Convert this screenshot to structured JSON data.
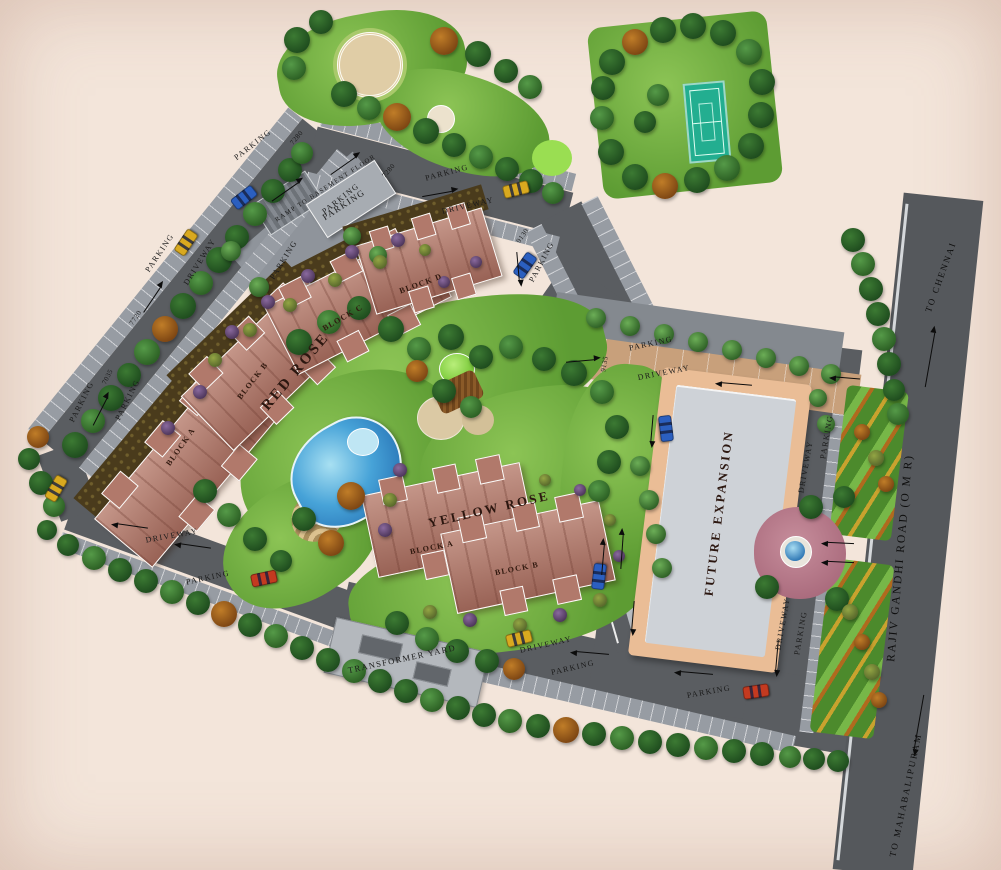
{
  "plan_title": "residential site master plan",
  "buildings": {
    "red_rose": {
      "name": "RED ROSE",
      "blocks": [
        "BLOCK A",
        "BLOCK B",
        "BLOCK C",
        "BLOCK D"
      ]
    },
    "yellow_rose": {
      "name": "YELLOW ROSE",
      "blocks": [
        "BLOCK A",
        "BLOCK B"
      ]
    }
  },
  "areas": {
    "future_expansion": "FUTURE EXPANSION",
    "transformer_yard": "TRANSFORMER YARD",
    "ramp": "RAMP TO BASEMENT FLOOR"
  },
  "road": {
    "name": "RAJIV GANDHI ROAD (O M R)",
    "north": "TO CHENNAI",
    "south": "TO MAHABALIPURAM"
  },
  "labels": {
    "parking": "PARKING",
    "driveway": "DRIVEWAY"
  },
  "dims": {
    "d1": "7280",
    "d2": "7280",
    "d3": "9130",
    "d4": "7720",
    "d5": "7035",
    "d6": "9135"
  },
  "palette": {
    "background": "#f3e5da",
    "road": "#5a5d61",
    "parking_bay": "#979ca3",
    "building": "#b1796b",
    "building_outline": "#ffffff",
    "future_expansion_fill": "#ced2d7",
    "future_expansion_border": "#eabd96",
    "lawn": "#79b24a",
    "pool": "#2f7fc8",
    "tennis_court": "#23ae90",
    "entrance_paving": "#c8a07b",
    "entrance_plaza": "#a96a7c"
  }
}
